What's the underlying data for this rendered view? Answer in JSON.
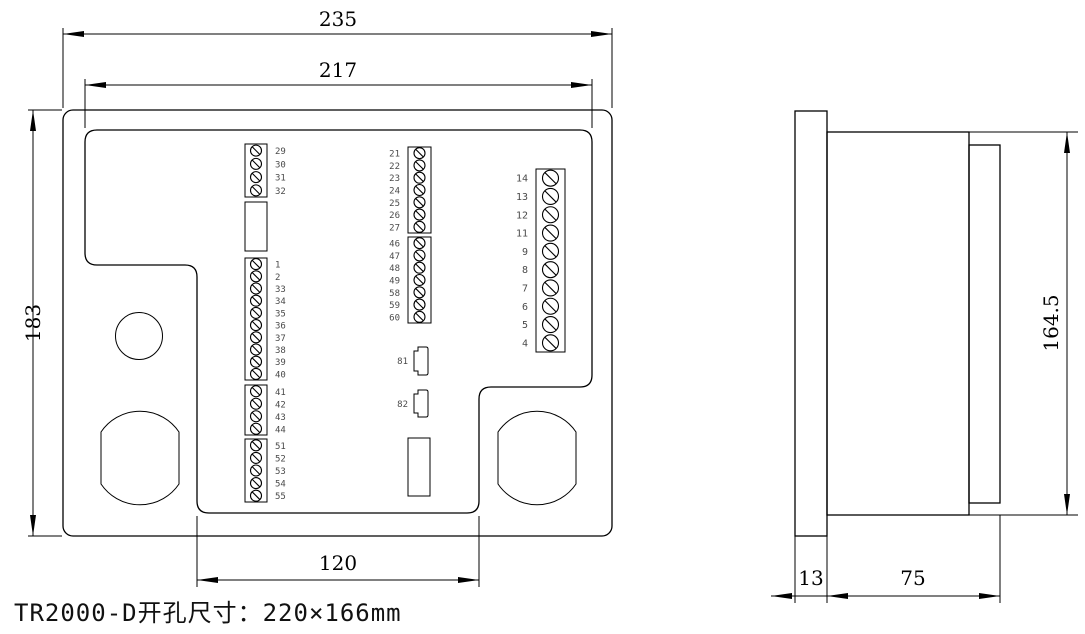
{
  "caption": "TR2000-D开孔尺寸：220×166mm",
  "dimensions": {
    "front_outer_width": "235",
    "front_inner_width": "217",
    "front_height": "183",
    "front_notch_width": "120",
    "side_height": "164.5",
    "side_bezel_depth": "13",
    "side_body_depth": "75"
  },
  "front_view": {
    "terminal_blocks": [
      {
        "id": "block-29-32",
        "labels": [
          "29",
          "30",
          "31",
          "32"
        ]
      },
      {
        "id": "block-1-40",
        "labels": [
          "1",
          "2",
          "33",
          "34",
          "35",
          "36",
          "37",
          "38",
          "39",
          "40"
        ]
      },
      {
        "id": "block-41-44",
        "labels": [
          "41",
          "42",
          "43",
          "44"
        ]
      },
      {
        "id": "block-51-55",
        "labels": [
          "51",
          "52",
          "53",
          "54",
          "55"
        ]
      },
      {
        "id": "block-21-27",
        "labels": [
          "21",
          "22",
          "23",
          "24",
          "25",
          "26",
          "27"
        ]
      },
      {
        "id": "block-46-60",
        "labels": [
          "46",
          "47",
          "48",
          "49",
          "58",
          "59",
          "60"
        ]
      },
      {
        "id": "block-4-14",
        "labels": [
          "14",
          "13",
          "12",
          "11",
          "9",
          "8",
          "7",
          "6",
          "5",
          "4"
        ]
      }
    ],
    "connectors": [
      {
        "id": "connector-81",
        "label": "81"
      },
      {
        "id": "connector-82",
        "label": "82"
      }
    ]
  },
  "colors": {
    "line": "#000000",
    "background": "#ffffff",
    "terminal_label": "#4a4a4a"
  }
}
